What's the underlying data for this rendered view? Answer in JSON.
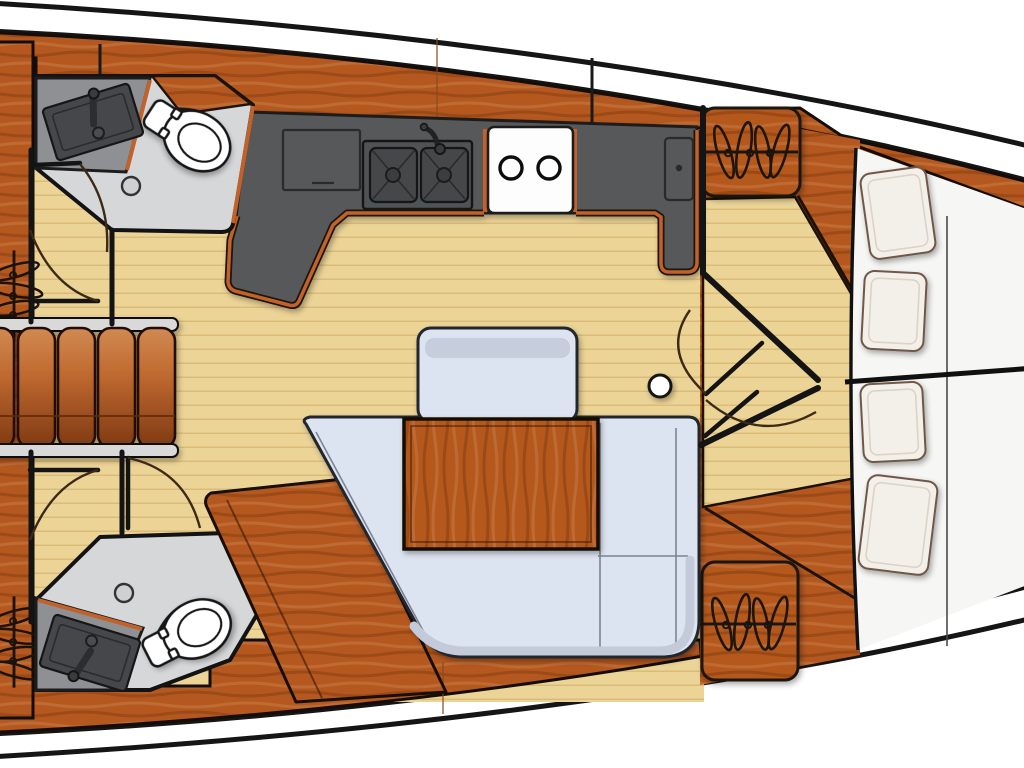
{
  "app": {
    "title": "Sailboat interior layout — overhead floor plan"
  },
  "colors": {
    "hull-outline": "#151515",
    "wood": "#b4581f",
    "wood-dark": "#8a3f14",
    "floor-tan": "#ecd497",
    "plank-line": "#d7b674",
    "counter-gray": "#57585a",
    "appliance-dark": "#45474a",
    "head-floor": "#d6d7d9",
    "vanity-gray": "#8e9093",
    "sofa-upholstery": "#dde4f1",
    "cushion-highlight": "#c3cad9",
    "bed-white": "#f6f6f4",
    "pillow": "#f3efe9",
    "trim-orange": "#c2622b",
    "steel-gray": "#d9d9d9"
  },
  "rooms": {
    "hull": {
      "label": "Yacht hull, bow to the right, white side decks"
    },
    "saloon": {
      "label": "Saloon with plank flooring, U-shaped sofa, table and bench"
    },
    "galley": {
      "label": "Galley counter with double sink, two-burner stove and fridge hatch"
    },
    "head_top": {
      "label": "Aft head (upper) with toilet and vanity sink"
    },
    "head_bottom": {
      "label": "Aft head (lower) with toilet and vanity sink"
    },
    "companionway": {
      "label": "Companionway steps with handrails"
    },
    "forward_cabin": {
      "label": "Forward cabin with island berth, four pillows and hanging lockers"
    }
  },
  "fixtures": {
    "steps": {
      "label": "Companionway steps"
    },
    "galley_sink": {
      "label": "Double galley sink with faucet"
    },
    "stove": {
      "label": "Two-burner stove"
    },
    "fridge": {
      "label": "Top-loading fridge hatch"
    },
    "counter_hatch": {
      "label": "Counter storage hatch"
    },
    "table": {
      "label": "Saloon table"
    },
    "bench": {
      "label": "Saloon bench seat"
    },
    "sofa": {
      "label": "U-shaped settee"
    },
    "mast": {
      "label": "Mast compression post"
    },
    "berth": {
      "label": "Forward island berth"
    },
    "pillows": {
      "label": "Berth pillows",
      "count": 4
    },
    "toilets": {
      "label": "Marine toilet",
      "count": 2
    },
    "vanity_sinks": {
      "label": "Vanity sink",
      "count": 2
    },
    "drains": {
      "label": "Shower floor drain",
      "count": 2
    },
    "lockers": {
      "label": "Hanging locker (clothes-hanger symbol)",
      "count": 4
    },
    "doors": {
      "label": "Door swing arc",
      "count": 6
    }
  }
}
